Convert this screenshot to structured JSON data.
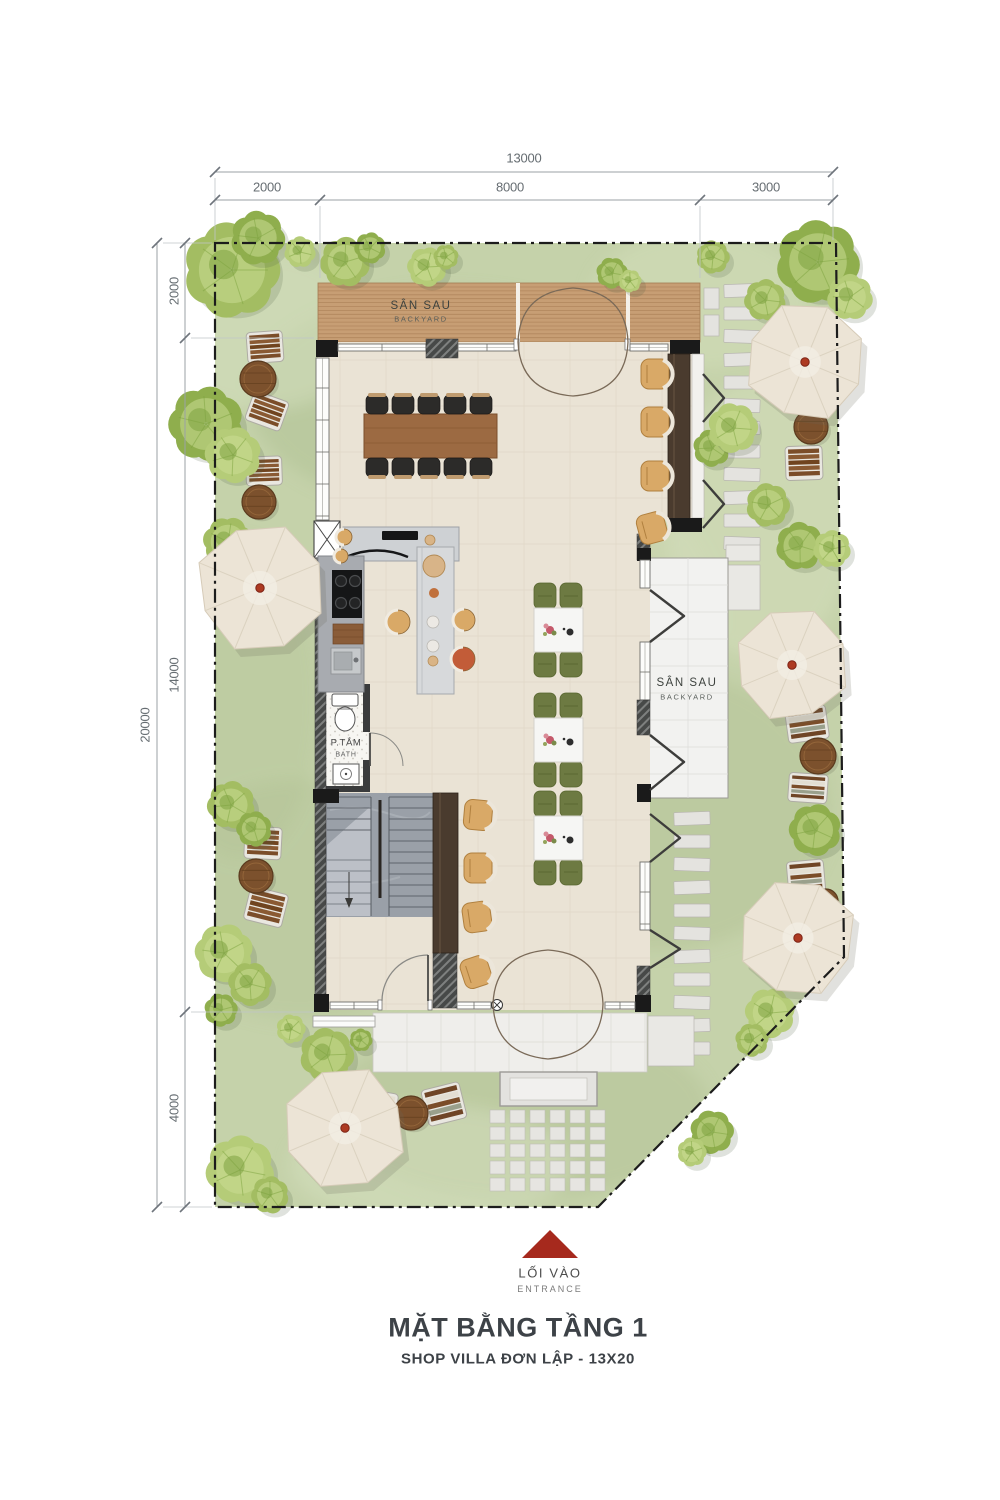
{
  "page": {
    "background": "#ffffff"
  },
  "title_block": {
    "title": "MẶT BẰNG TẦNG 1",
    "subtitle": "SHOP VILLA ĐƠN LẬP  - 13X20"
  },
  "entrance_marker": {
    "label_primary": "LỐI VÀO",
    "label_secondary": "ENTRANCE",
    "arrow_color": "#a6291d"
  },
  "dimensions": {
    "top": {
      "total": "13000",
      "segments": [
        {
          "label": "2000"
        },
        {
          "label": "8000"
        },
        {
          "label": "3000"
        }
      ]
    },
    "left": {
      "total": "20000",
      "segments": [
        {
          "label": "2000"
        },
        {
          "label": "14000"
        },
        {
          "label": "4000"
        }
      ]
    }
  },
  "labels": {
    "deck_backyard": {
      "primary": "SÂN SAU",
      "secondary": "BACKYARD"
    },
    "patio_backyard": {
      "primary": "SÂN SAU",
      "secondary": "BACKYARD"
    },
    "bath": {
      "primary": "P.TẮM",
      "secondary": "BATH"
    }
  },
  "colors": {
    "grass": "#c5d2aa",
    "grass_dark": "#aebf92",
    "grass_light": "#d6e0bf",
    "floor": "#eae3d5",
    "porch": "#efeeeb",
    "patio": "#f2f2f0",
    "deck_wood": "#c79e74",
    "deck_slat": "#a87d54",
    "wall_dark": "#1a1a1a",
    "wood_partition": "#4a3b2e",
    "stair": "#9aa0a8",
    "table_wood": "#9c6a42",
    "chair_black": "#2c2b29",
    "chair_olive": "#6d7a42",
    "chair_tan": "#d9a967",
    "stool_red": "#c25c38",
    "umbrella": "#ece4d6",
    "bench_wood": "#7b4d29",
    "round_table": "#7c512d",
    "dim_line": "#9ba1a6",
    "accent_red": "#a6291d",
    "tree_greens": [
      "#a3bd62",
      "#8fae4d",
      "#b5cc78"
    ]
  }
}
